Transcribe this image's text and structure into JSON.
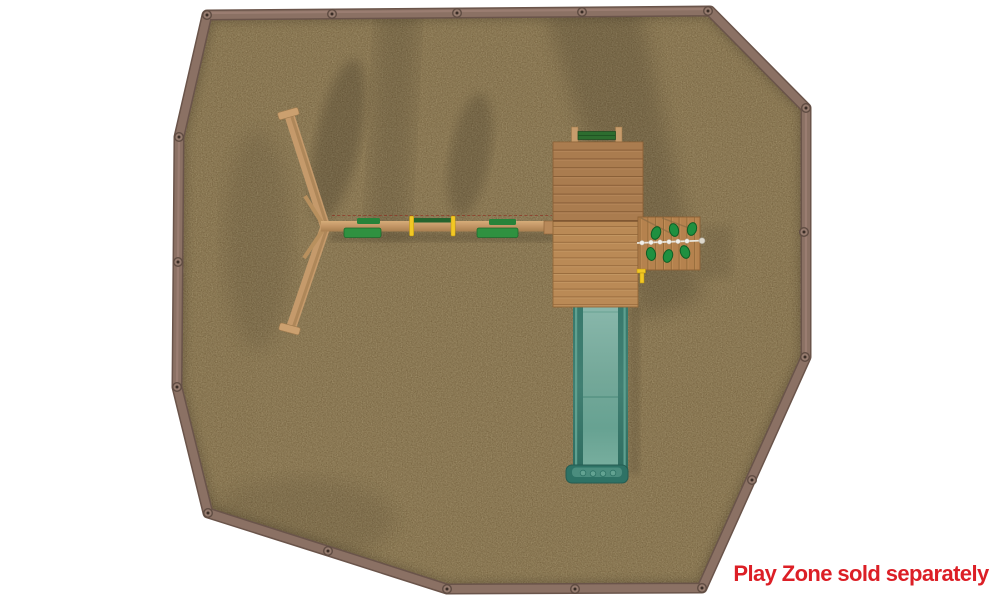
{
  "caption": {
    "text": "Play Zone sold separately",
    "color": "#dc1f26"
  },
  "scene": {
    "view": "top-down product render",
    "background_color": "#ffffff",
    "play_zone": {
      "surface": "rubber-mulch",
      "mulch_color": "#75613e",
      "border_timber_color": "#8b7164",
      "border_shape": "irregular-octagon",
      "corner_cap_count": 17,
      "cap_color": "#957b6e"
    },
    "objects": [
      {
        "name": "a-frame-swing-legs",
        "color": "#c59a6b"
      },
      {
        "name": "swing-beam",
        "color": "#c9a06d"
      },
      {
        "name": "swing-seat-left",
        "color": "#2f9140"
      },
      {
        "name": "swing-seat-right",
        "color": "#2f9140"
      },
      {
        "name": "trapeze-bar",
        "color": "#f2c824"
      },
      {
        "name": "upper-deck",
        "color": "#aa7c4f"
      },
      {
        "name": "lower-deck",
        "color": "#ba8a56"
      },
      {
        "name": "entry-bar",
        "color": "#2d6d2f"
      },
      {
        "name": "rock-climbing-wall",
        "plank_color": "#b5824e",
        "holds_count": 6,
        "holds_color": "#1f9040",
        "rope_color": "#e8e4da"
      },
      {
        "name": "wave-slide",
        "rail_color": "#37796c",
        "bed_color": "#86b4a8"
      }
    ]
  }
}
